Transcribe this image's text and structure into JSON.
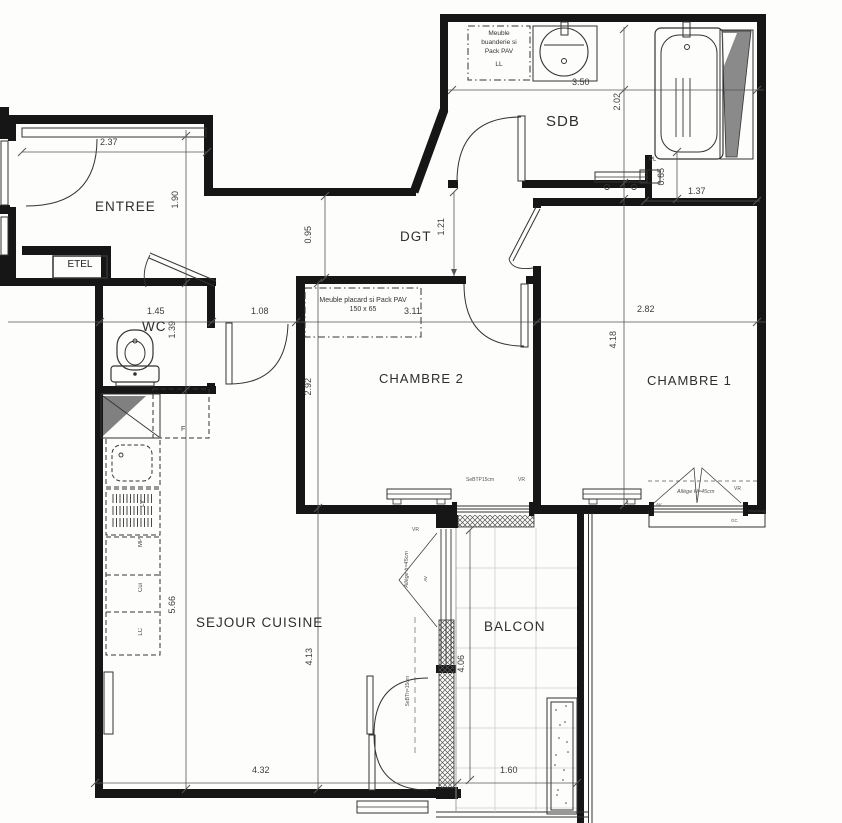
{
  "plan": {
    "rooms": {
      "entree": "ENTREE",
      "sdb": "SDB",
      "dgt": "DGT",
      "wc": "WC",
      "chambre2": "CHAMBRE 2",
      "chambre1": "CHAMBRE 1",
      "sejour": "SEJOUR CUISINE",
      "balcon": "BALCON"
    },
    "dimensions": {
      "d237": "2.37",
      "d190": "1.90",
      "d350": "3.50",
      "d202": "2.02",
      "d065": "0.65",
      "d137": "1.37",
      "d095": "0.95",
      "d121": "1.21",
      "d145": "1.45",
      "d108": "1.08",
      "d311": "3.11",
      "d282": "2.82",
      "d139": "1.39",
      "d418": "4.18",
      "d292": "2.92",
      "d566": "5.66",
      "d413": "4.13",
      "d406": "4.06",
      "d432": "4.32",
      "d160": "1.60"
    },
    "annotations": {
      "laundry": [
        "Meuble",
        "buanderie si",
        "Pack PAV",
        "LL"
      ],
      "placard_l1": "Meuble placard si Pack PAV",
      "placard_l2": "150 x  65",
      "etel": "ETEL",
      "pl": "PL",
      "f": "F",
      "lv": "LV",
      "mp": "MP",
      "cui": "Cui",
      "lc": "LC",
      "gc": "GC",
      "vr": "VR",
      "av": "AV",
      "win_ch2": "SeBTP15cm",
      "win_ch1": "Allège H=45cm",
      "win_sejour": "Allège h=45cm",
      "door_sejour": "SeBTh=15cm"
    },
    "colors": {
      "wall": "#161616",
      "line": "#333333",
      "dim_line": "#555555",
      "gray_fill": "#8a8a8a",
      "tile_line": "#cccccc"
    }
  }
}
